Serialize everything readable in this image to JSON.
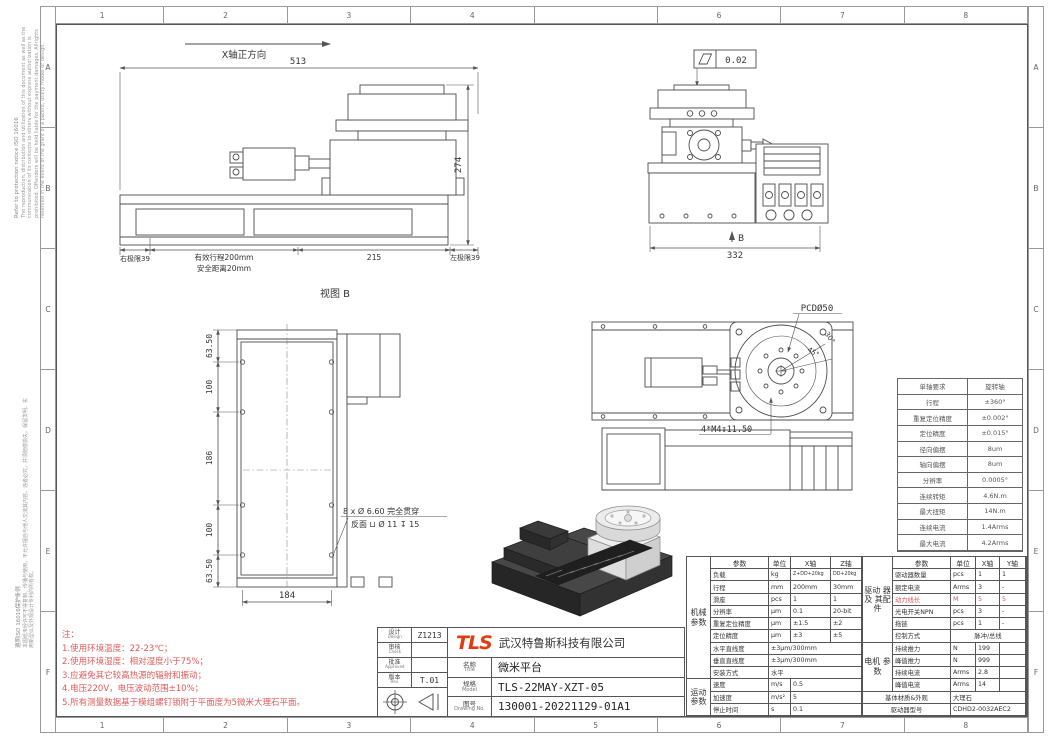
{
  "colors": {
    "accent_red": "#e05252",
    "logo_red": "#e8380d",
    "line_gray": "#4d4d4d"
  },
  "frame": {
    "top_zones": [
      "1",
      "2",
      "3",
      "4",
      "",
      "6",
      "7",
      "8"
    ],
    "bottom_zones": [
      "1",
      "2",
      "3",
      "4",
      "5",
      "6",
      "7",
      "8"
    ],
    "left_zones": [
      "A",
      "B",
      "C",
      "D",
      "E",
      "F"
    ],
    "right_zones": [
      "A",
      "B",
      "C",
      "D",
      "E",
      "F"
    ],
    "notice_en_title": "Refer to protection notice ISO 16016",
    "notice_en_body": "The reproduction, distribution and utilization of this document as well as the communication of its contents to others without express authorization is prohibited. Offenders will be held liable for the payment damages. Allrights reserved in the event of the grant of a patent, utility model or design.",
    "notice_cn_title": "遵照ISO 16016保护条例",
    "notice_cn_body": "本图纸未经许可不得复制、传播与使用，不允许擅自与他人交流其内容。违者必究，并须赔偿损失。保留发明、实用新型以及外观设计专利的所有权。"
  },
  "front_view": {
    "axis_label": "X轴正方向",
    "dim_width": "513",
    "dim_height": "274",
    "dim_right_limit": "右极限39",
    "dim_travel": "有效行程200mm",
    "dim_safety": "安全距离20mm",
    "dim_mid": "215",
    "dim_left_limit": "左极限39"
  },
  "rear_view": {
    "flatness": "0.02",
    "dim_width": "332",
    "view_label": "B"
  },
  "view_b": {
    "title": "视图 B",
    "dim_v1": "63.50",
    "dim_v2": "100",
    "dim_v3": "186",
    "dim_v4": "100",
    "dim_v5": "63.50",
    "dim_width": "184",
    "hole_note1": "8 x Ø 6.60 完全贯穿",
    "hole_note2": "反面 ⊔ Ø 11 ↧ 15"
  },
  "top_view": {
    "pcd": "PCDØ50",
    "thread": "4*M4↧11.50",
    "angle1": "45°",
    "angle2": "30°"
  },
  "axis_table": {
    "rows": [
      {
        "k": "单轴要求",
        "v": "旋转轴"
      },
      {
        "k": "行程",
        "v": "±360°"
      },
      {
        "k": "重复定位精度",
        "v": "±0.002°"
      },
      {
        "k": "定位精度",
        "v": "±0.015°"
      },
      {
        "k": "径向偏摆",
        "v": "8um"
      },
      {
        "k": "轴向偏摆",
        "v": "8um"
      },
      {
        "k": "分辨率",
        "v": "0.0005°"
      },
      {
        "k": "连续转矩",
        "v": "4.6N.m"
      },
      {
        "k": "最大扭矩",
        "v": "14N.m"
      },
      {
        "k": "连续电流",
        "v": "1.4Arms"
      },
      {
        "k": "最大电流",
        "v": "4.2Arms"
      }
    ]
  },
  "notes": {
    "title": "注：",
    "n1": "1.使用环境温度：22-23℃；",
    "n2": "2.使用环境湿度：相对湿度小于75%；",
    "n3": "3.应避免其它较高热源的辐射和振动；",
    "n4": "4.电压220V，电压波动范围±10%；",
    "n5": "5.所有测量数据基于模组螺钉锁附于平面度为5微米大理石平面。"
  },
  "title_block": {
    "design_cn": "设计",
    "design_en": "Design",
    "design_val": "Z1213",
    "check_cn": "审核",
    "check_en": "Check",
    "check_val": "",
    "approved_cn": "批准",
    "approved_en": "Approved",
    "approved_val": "",
    "rev_cn": "版本",
    "rev_en": "Rev.",
    "rev_val": "T.01",
    "logo": "TLS",
    "company": "武汉特鲁斯科技有限公司",
    "name_cn": "名称",
    "name_en": "Title",
    "name_val": "微米平台",
    "model_cn": "规格",
    "model_en": "Model",
    "model_val": "TLS-22MAY-XZT-05",
    "dwg_cn": "图号",
    "dwg_en": "Drawing No.",
    "dwg_val": "130001-20221129-01A1"
  },
  "params": {
    "left": {
      "group1": "机械 参数",
      "group2": "运动 参数",
      "h": [
        "参数",
        "单位",
        "X轴",
        "Z轴"
      ],
      "rows": [
        [
          "负载",
          "kg",
          "Z+DD+20kg",
          "DD+20kg"
        ],
        [
          "行程",
          "mm",
          "200mm",
          "30mm"
        ],
        [
          "滑座",
          "pcs",
          "1",
          "1"
        ],
        [
          "分辨率",
          "μm",
          "0.1",
          "20-bit"
        ],
        [
          "重复定位精度",
          "μm",
          "±1.5",
          "±2"
        ],
        [
          "定位精度",
          "μm",
          "±3",
          "±5"
        ],
        [
          "水平直线度",
          "±3μm/300mm"
        ],
        [
          "垂直直线度",
          "±3μm/300mm"
        ],
        [
          "安装方式",
          "水平"
        ],
        [
          "速度",
          "m/s",
          "0.5"
        ],
        [
          "加速度",
          "m/s²",
          "5"
        ],
        [
          "停止时间",
          "s",
          "0.1"
        ]
      ]
    },
    "right": {
      "group1": "驱动 器及 其配 件",
      "group2": "电机 参数",
      "h": [
        "参数",
        "单位",
        "X轴",
        "Y轴"
      ],
      "rows": [
        [
          "驱动器数量",
          "pcs",
          "1",
          "1"
        ],
        [
          "额定电流",
          "Arms",
          "3",
          "-"
        ],
        [
          "动力线长",
          "M",
          "5",
          "5"
        ],
        [
          "光电开关NPN",
          "pcs",
          "3",
          "-"
        ],
        [
          "拖链",
          "pcs",
          "1",
          "-"
        ],
        [
          "控制方式",
          "脉冲/总线"
        ],
        [
          "持续推力",
          "N",
          "199"
        ],
        [
          "峰值推力",
          "N",
          "999"
        ],
        [
          "持续电流",
          "Arms",
          "2.8"
        ],
        [
          "峰值电流",
          "Arms",
          "14"
        ],
        [
          "基体材质&外观",
          "大理石"
        ],
        [
          "驱动器型号",
          "CDHD2-0032AEC2"
        ]
      ]
    }
  }
}
